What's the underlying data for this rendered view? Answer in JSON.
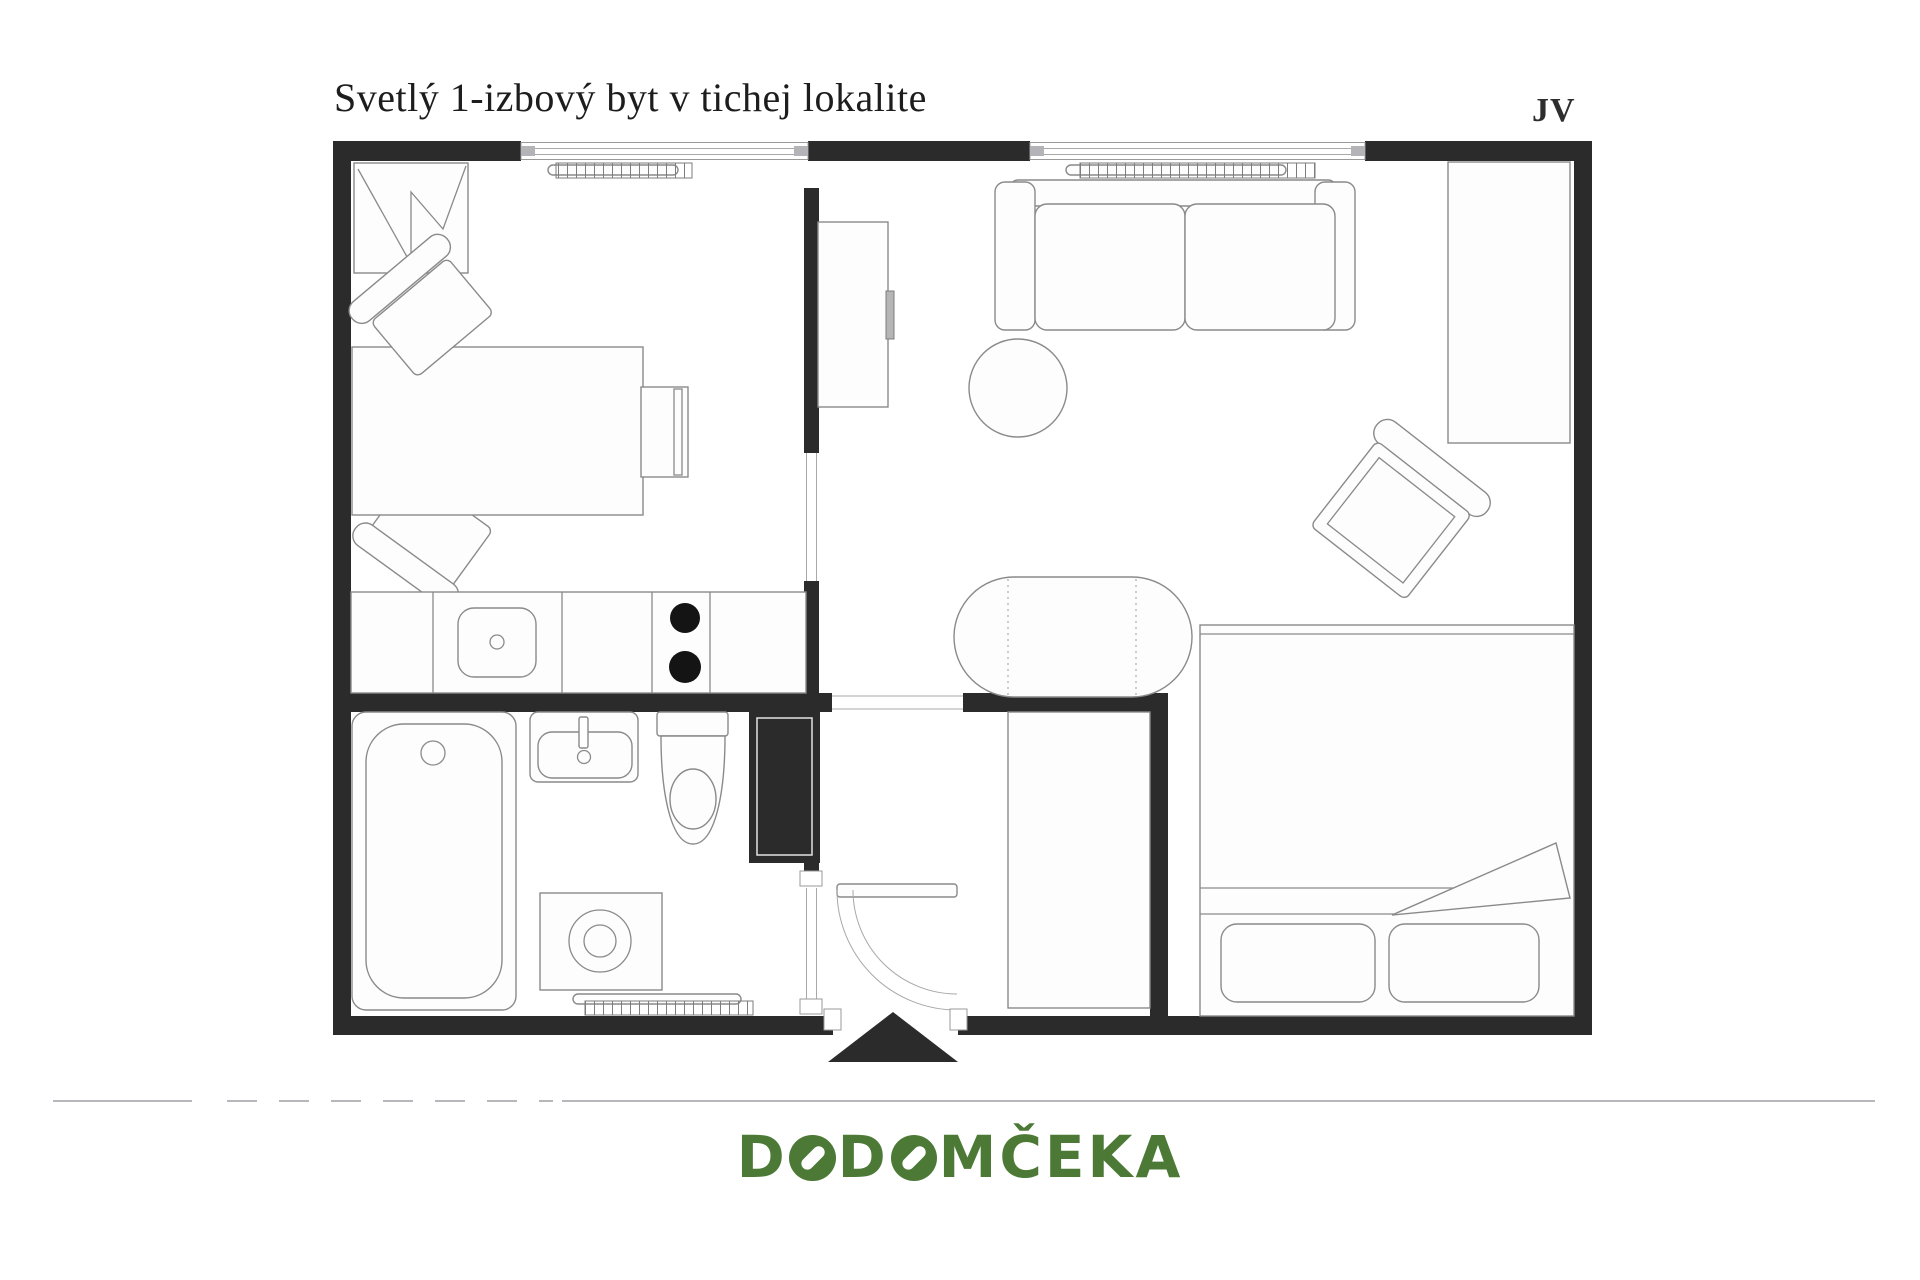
{
  "header": {
    "title": "Svetlý 1-izbový byt v tichej lokalite",
    "orientation_label": "JV"
  },
  "footer": {
    "logo_text": "DODOMČEKA"
  },
  "colors": {
    "background": "#ffffff",
    "wall": "#2b2b2b",
    "furniture_line": "#8a8a8a",
    "separator_line": "#b8b8bc",
    "logo_green": "#4c7a36"
  }
}
